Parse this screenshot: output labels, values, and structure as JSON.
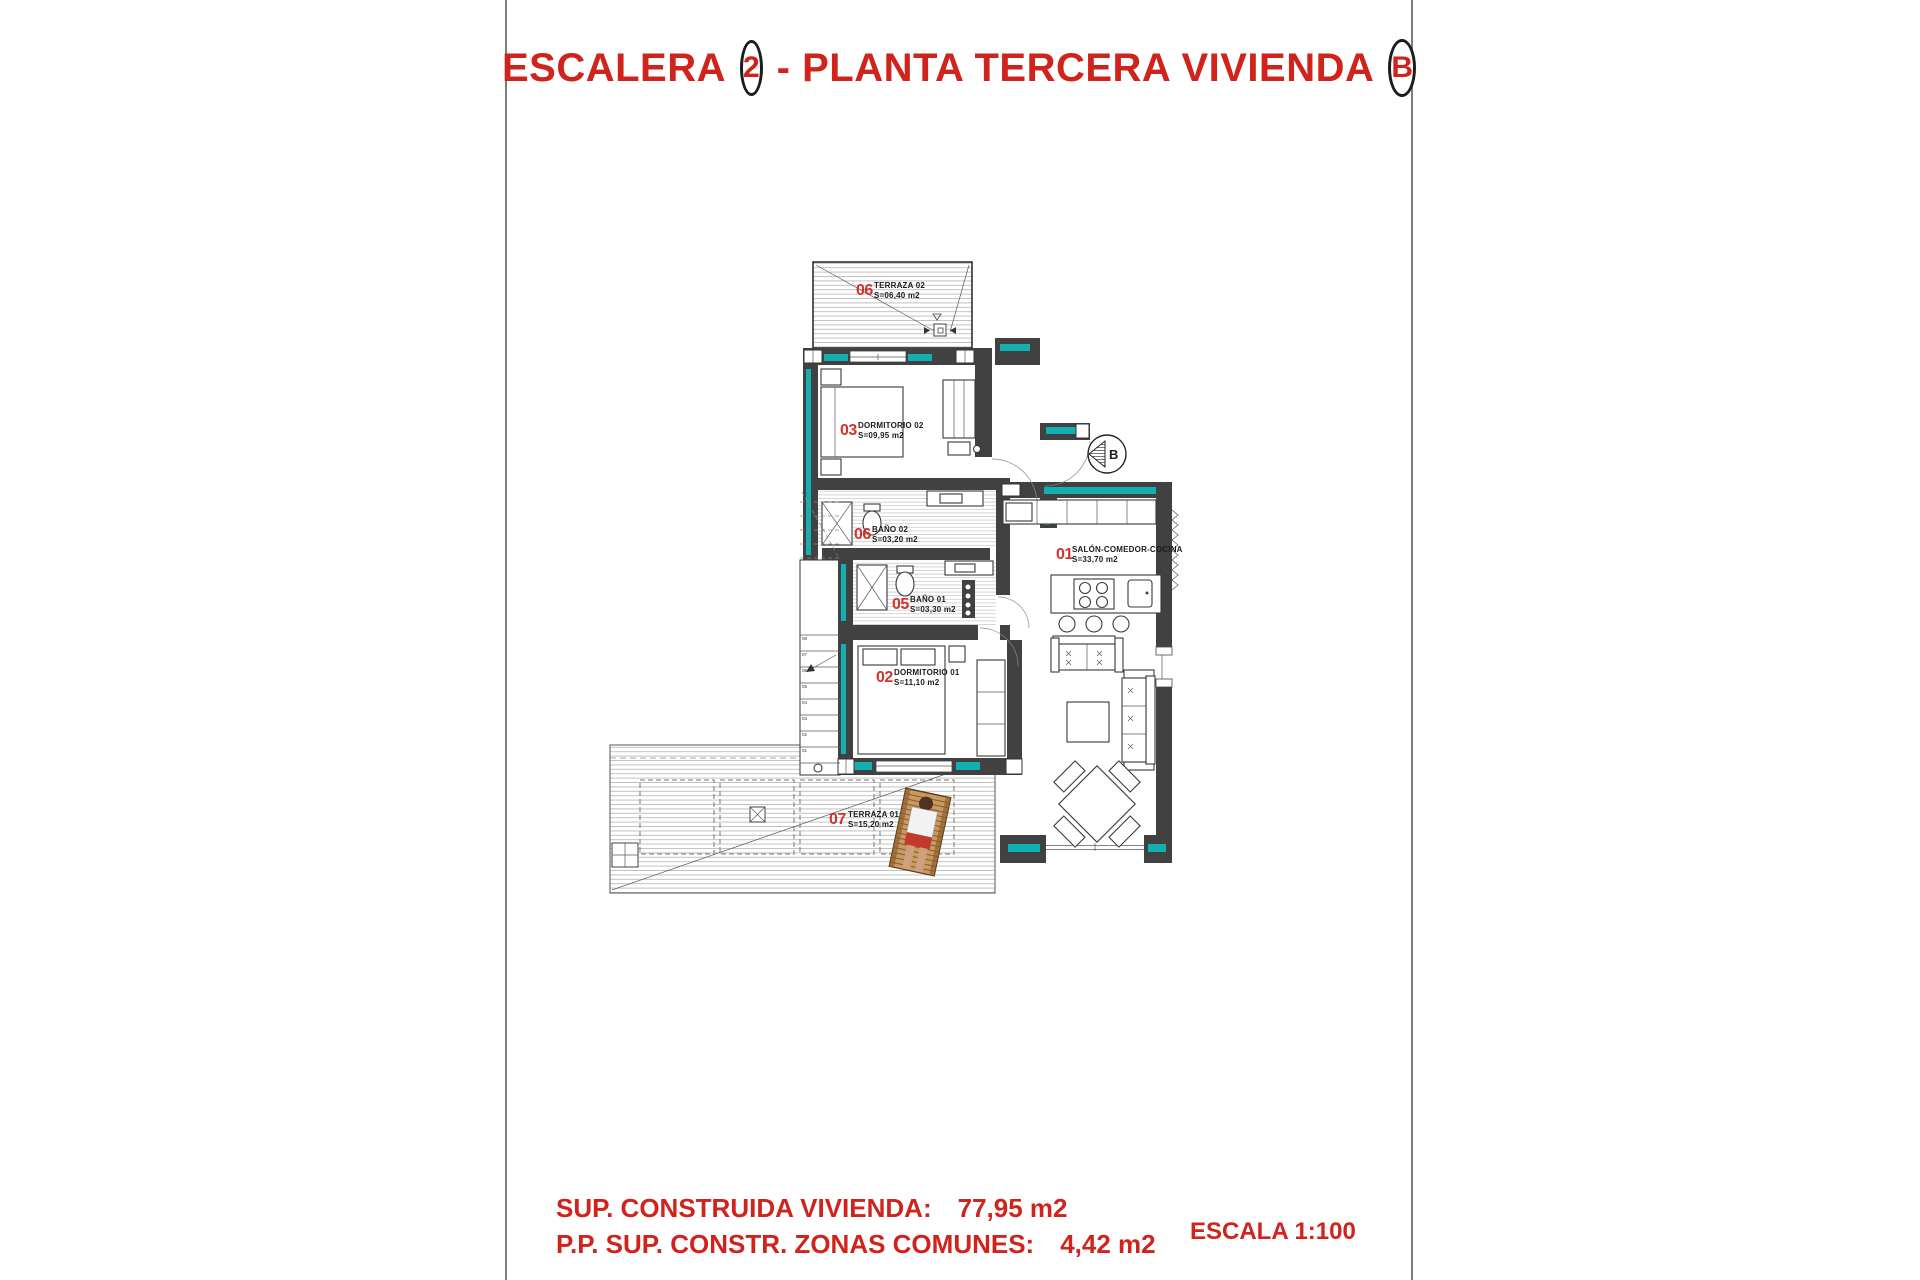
{
  "title": {
    "part1": "ESCALERA",
    "badge1": "2",
    "part2": "- PLANTA TERCERA VIVIENDA",
    "badge2": "B"
  },
  "plan": {
    "rooms": [
      {
        "num": "06",
        "name": "TERRAZA 02",
        "area": "S=06,40 m2"
      },
      {
        "num": "03",
        "name": "DORMITORIO 02",
        "area": "S=09,95 m2"
      },
      {
        "num": "06",
        "name": "BAÑO 02",
        "area": "S=03,20 m2"
      },
      {
        "num": "05",
        "name": "BAÑO 01",
        "area": "S=03,30 m2"
      },
      {
        "num": "02",
        "name": "DORMITORIO 01",
        "area": "S=11,10 m2"
      },
      {
        "num": "01",
        "name": "SALÓN-COMEDOR-COCINA",
        "area": "S=33,70 m2"
      },
      {
        "num": "07",
        "name": "TERRAZA 01",
        "area": "S=15,20 m2"
      }
    ],
    "section_marker": "B",
    "stair_steps": [
      "08",
      "07",
      "06",
      "05",
      "04",
      "03",
      "02",
      "01"
    ]
  },
  "footer": {
    "line1_label": "SUP. CONSTRUIDA VIVIENDA:",
    "line1_value": "77,95 m2",
    "line2_label": "P.P. SUP. CONSTR. ZONAS COMUNES:",
    "line2_value": "4,42 m2",
    "scale": "ESCALA 1:100"
  },
  "colors": {
    "accent_red": "#cf231c",
    "wall_teal": "#12b0b0",
    "wall_dark": "#414141"
  }
}
